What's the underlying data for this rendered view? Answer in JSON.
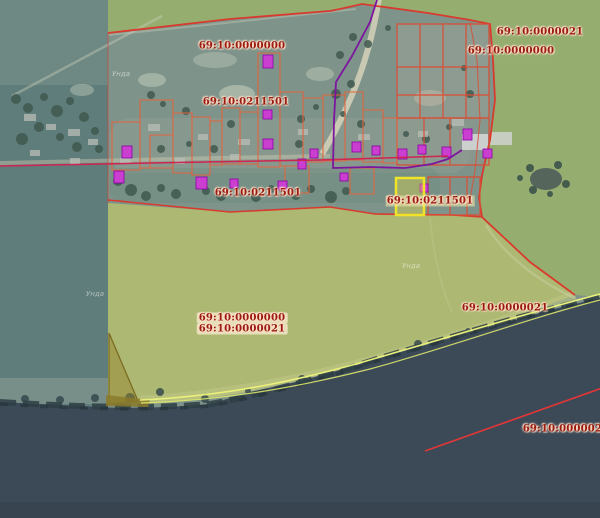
{
  "viewer": {
    "type": "public-cadastral-map",
    "selected_parcel_number": "69:10:0211501"
  },
  "colors": {
    "boundary_red": "#d93a2e",
    "parcel_line_orange": "#e0653e",
    "building_magenta_fill": "#cb3fd0",
    "building_magenta_stroke": "#8d00a8",
    "boundary_purple": "#7d159e",
    "boundary_crimson": "#cf2553",
    "selection_yellow": "#f0e428",
    "shoreline_yellow": "#eaf07c",
    "water_dark": "#3c4a58",
    "field_green": "#95ae70",
    "field_yellow_green": "#adb873",
    "village_teal": "#7e948b",
    "label_dark_red": "#9a1b10"
  },
  "cadastral_labels": [
    {
      "text": "69:10:0000000"
    },
    {
      "text": "69:10:0211501"
    },
    {
      "text": "69:10:0211501"
    },
    {
      "text": "69:10:0000021"
    },
    {
      "text": "69:10:0000000"
    },
    {
      "text": "69:10:0211501"
    },
    {
      "text": "69:10:0000000"
    },
    {
      "text": "69:10:0000021"
    },
    {
      "text": "69:10:0000021"
    },
    {
      "text": "69:10:0000021"
    }
  ],
  "place_labels": [
    {
      "text": "Унда"
    },
    {
      "text": "Унда"
    },
    {
      "text": "Унда"
    }
  ]
}
